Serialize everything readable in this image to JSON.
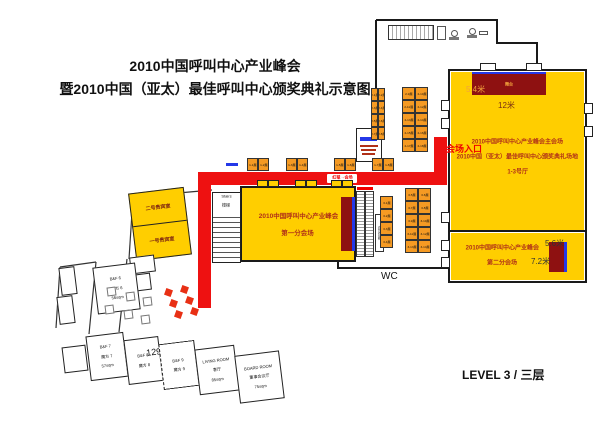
{
  "title": {
    "line1": "2010中国呼叫中心产业峰会",
    "line2": "暨2010中国（亚太）最佳呼叫中心颁奖典礼示意图"
  },
  "level_label": "LEVEL 3 / 三层",
  "halls": {
    "main": {
      "line1": "2010中国呼叫中心产业峰会主会场",
      "line2": "2010中国（亚太）最佳呼叫中心颁奖典礼场地",
      "line3": "1-3号厅",
      "entrance": "会场入口"
    },
    "hall1": {
      "line1": "2010中国呼叫中心产业峰会",
      "line2": "第一分会场"
    },
    "hall2": {
      "line1": "2010中国呼叫中心产业峰会",
      "line2": "第二分会场"
    }
  },
  "rooms": {
    "vip2": "二号贵宾室",
    "vip1": "一号贵宾室",
    "bf6": [
      "B&F 6",
      "魔方 6",
      "56sqm"
    ],
    "bf7": [
      "B&F 7",
      "魔方 7",
      "57sqm"
    ],
    "bf8": [
      "B&F 8",
      "魔方 8"
    ],
    "bf9": [
      "B&F 9",
      "魔方 9"
    ],
    "area_129": "129sqm",
    "living": [
      "LIVING ROOM",
      "客厅",
      "85sqm"
    ],
    "board": [
      "BOARD ROOM",
      "董事会议厅",
      "75sqm"
    ],
    "stairs": [
      "Stairs",
      "楼梯"
    ],
    "wc": "WC",
    "escalator_label": "自动扶梯"
  },
  "stage": {
    "main_label": "舞台",
    "main_depth": "5.4米",
    "main_width": "12米",
    "h2_width": "5.6米",
    "h2_depth": "7.2米"
  },
  "route_badge": "红毯→会场",
  "booths": {
    "corridor": [
      "1-1展",
      "1-2展",
      "1-3展",
      "1-4展",
      "1-5展",
      "1-6展",
      "1-7展",
      "1-8展"
    ],
    "top_left": [
      "2-1展",
      "2-2展",
      "2-3展",
      "2-4展",
      "2-5展",
      "2-6展",
      "2-7展",
      "2-8展"
    ],
    "top_grid": [
      "2-9展",
      "2-10展",
      "2-11展",
      "2-12展",
      "2-13展",
      "2-14展",
      "2-15展",
      "2-16展",
      "2-17展",
      "2-18展"
    ],
    "mid_col": [
      "3-1展",
      "3-2展",
      "3-3展",
      "3-4展"
    ],
    "right_grid": [
      "3-5展",
      "3-6展",
      "3-7展",
      "3-8展",
      "3-9展",
      "3-10展",
      "3-11展",
      "3-12展",
      "3-13展",
      "3-14展"
    ]
  },
  "colors": {
    "hall_yellow": "#FFCE00",
    "booth_orange": "#F59A23",
    "route_red": "#EE1111",
    "stage_maroon": "#8E1111",
    "stage_blue": "#2438E8",
    "hall_text": "#B03018"
  }
}
